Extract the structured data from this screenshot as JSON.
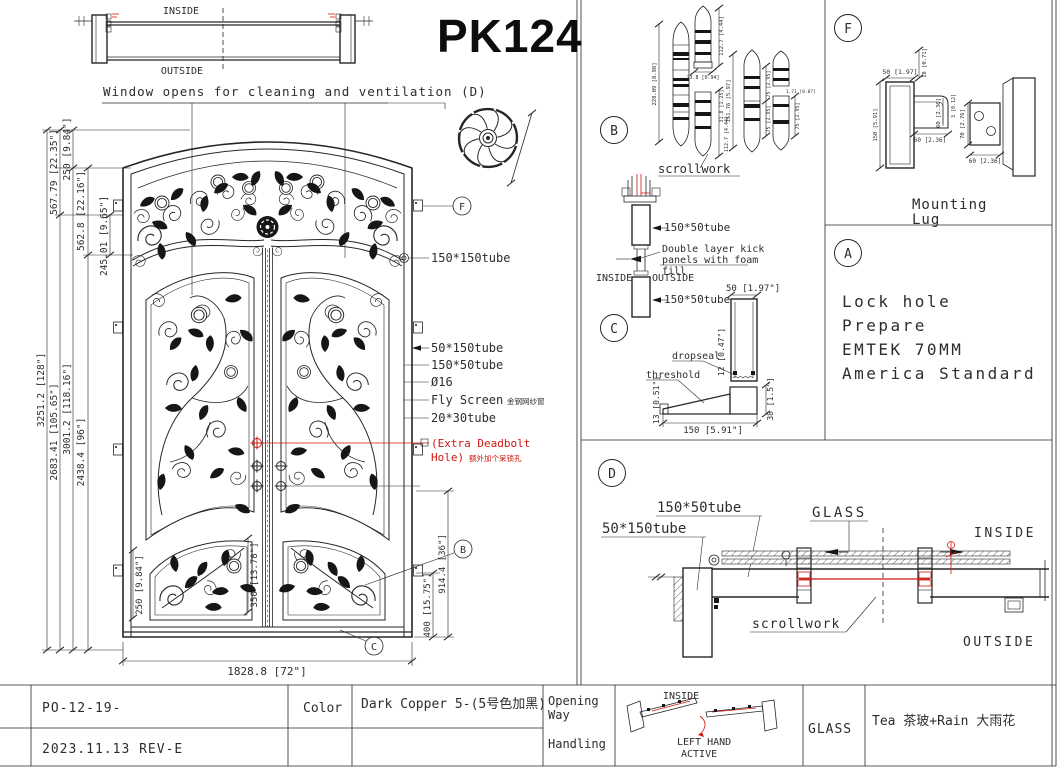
{
  "header": {
    "drawing_no": "PK124"
  },
  "plan_view": {
    "inside": "INSIDE",
    "outside": "OUTSIDE",
    "caption": "Window opens for cleaning and ventilation (D)"
  },
  "elevation": {
    "dims_left": [
      "3251.2 [128\"]",
      "2683.41 [105.65\"]",
      "3001.2 [118.16\"]",
      "2438.4 [96\"]",
      "567.79 [22.35\"]",
      "250 [9.84\"]",
      "562.8 [22.16\"]",
      "245.01 [9.65\"]"
    ],
    "dims_right": [
      "914.4 [36\"]",
      "400 [15.75\"]"
    ],
    "dim_bottom": "1828.8 [72\"]",
    "dims_inner": [
      "250 [9.84\"]",
      "350 [13.78\"]"
    ],
    "callouts": [
      "150*150tube",
      "50*150tube",
      "150*50tube",
      "Ø16",
      "Fly Screen",
      "20*30tube"
    ],
    "fly_screen_cn": "金钢网纱窗",
    "deadbolt_note": [
      "(Extra Deadbolt",
      "Hole)",
      "额外加个呆锁孔"
    ],
    "markers": {
      "f": "F",
      "b": "B",
      "c": "C"
    }
  },
  "panel_b": {
    "label": "B",
    "scrollwork": "scrollwork",
    "hinge_dims": [
      "228.09 [8.98]",
      "112.7 [4.44]",
      "23.8 [0.94]",
      "31.8 [1.25]",
      "112.7 [4.44]",
      "151.76 [5.97]",
      "75 [2.95]",
      "75 [2.95]",
      "1.71 [0.07]",
      "75 [2.95]"
    ]
  },
  "panel_c": {
    "label": "C",
    "tube_top": "150*50tube",
    "tube_bottom": "150*50tube",
    "kick_note": [
      "Double layer kick",
      "panels with foam",
      "fill"
    ],
    "inside": "INSIDE",
    "outside": "OUTSIDE",
    "dim_width": "50 [1.97\"]",
    "dropseal": "dropseal",
    "threshold": "threshold",
    "dim_dropseal": "12 [0.47\"]",
    "dim_threshold_h": "13 [0.51\"]",
    "dim_rail_h": "38 [1.5\"]",
    "dim_depth": "150 [5.91\"]"
  },
  "panel_f": {
    "label": "F",
    "caption": [
      "Mounting",
      "Lug"
    ],
    "dims": [
      "50 [1.97]",
      "18 [0.71]",
      "150 [5.91]",
      "60 [2.36]",
      "3 [0.12]",
      "60 [2.36]",
      "70 [2.76]",
      "60 [2.36]"
    ]
  },
  "panel_a": {
    "label": "A",
    "lines": [
      "Lock hole",
      "Prepare",
      "EMTEK 70MM",
      "America Standard"
    ]
  },
  "panel_d": {
    "label": "D",
    "tube_h": "150*50tube",
    "tube_v": "50*150tube",
    "glass": "GLASS",
    "inside": "INSIDE",
    "outside": "OUTSIDE",
    "scrollwork": "scrollwork"
  },
  "title_block": {
    "po": "PO-12-19-",
    "rev": "2023.11.13 REV-E",
    "color_label": "Color",
    "color_value": "Dark Copper 5-(5号色加黑)",
    "opening": [
      "Opening",
      "Way",
      "Handling"
    ],
    "inside": "INSIDE",
    "hand": [
      "LEFT HAND",
      "ACTIVE"
    ],
    "glass_label": "GLASS",
    "glass_value": "Tea 茶玻+Rain 大雨花"
  }
}
